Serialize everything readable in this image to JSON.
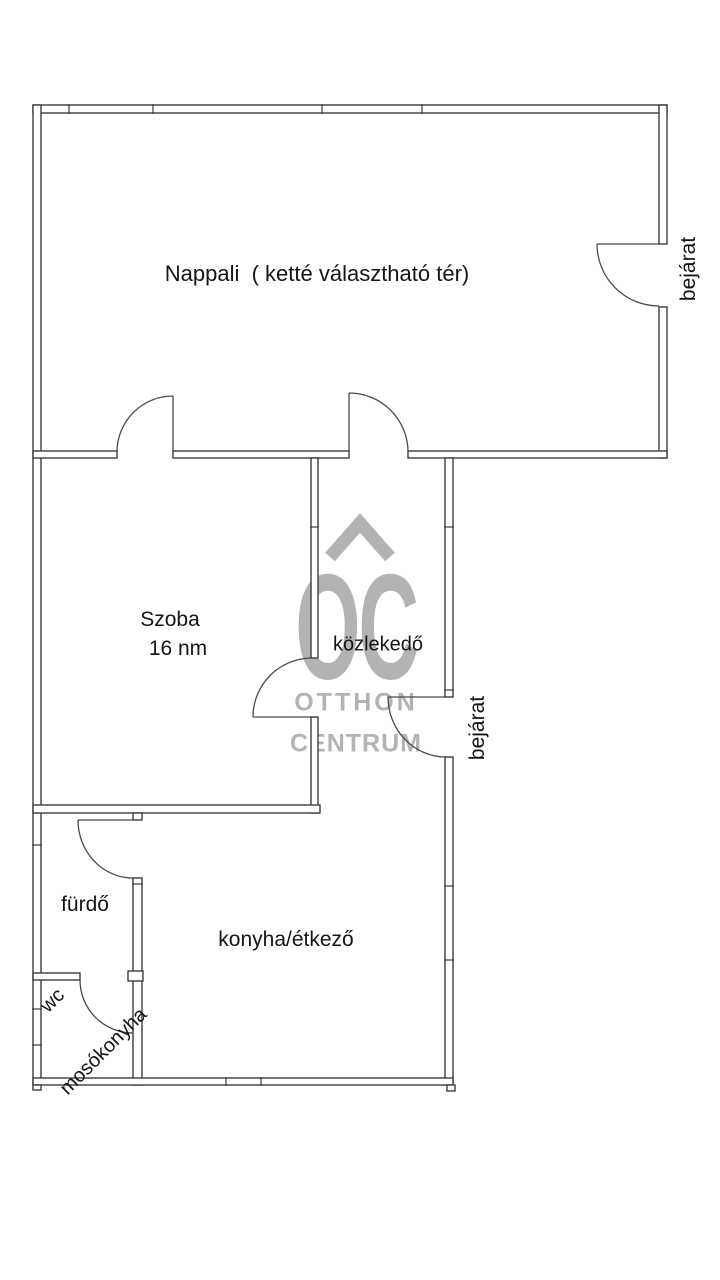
{
  "floorplan": {
    "rooms": {
      "nappali": {
        "label": "Nappali  ( ketté választható tér)"
      },
      "szoba": {
        "label": "Szoba",
        "area": "16 nm"
      },
      "kozlekedo": {
        "label": "közlekedő"
      },
      "bejarat_top": {
        "label": "bejárat"
      },
      "bejarat_mid": {
        "label": "bejárat"
      },
      "furdo": {
        "label": "fürdő"
      },
      "wc": {
        "label_line1": "wc",
        "label_line2": "mosókonyha"
      },
      "konyha": {
        "label": "konyha/étkező"
      }
    },
    "watermark": {
      "logo": "OC",
      "line1": "OTTHON",
      "line2": "CENTRUM",
      "color": "#b3b3b3"
    },
    "colors": {
      "wall": "#3d3d3d",
      "door": "#4a4a4a",
      "text": "#151515",
      "background": "#ffffff"
    }
  }
}
